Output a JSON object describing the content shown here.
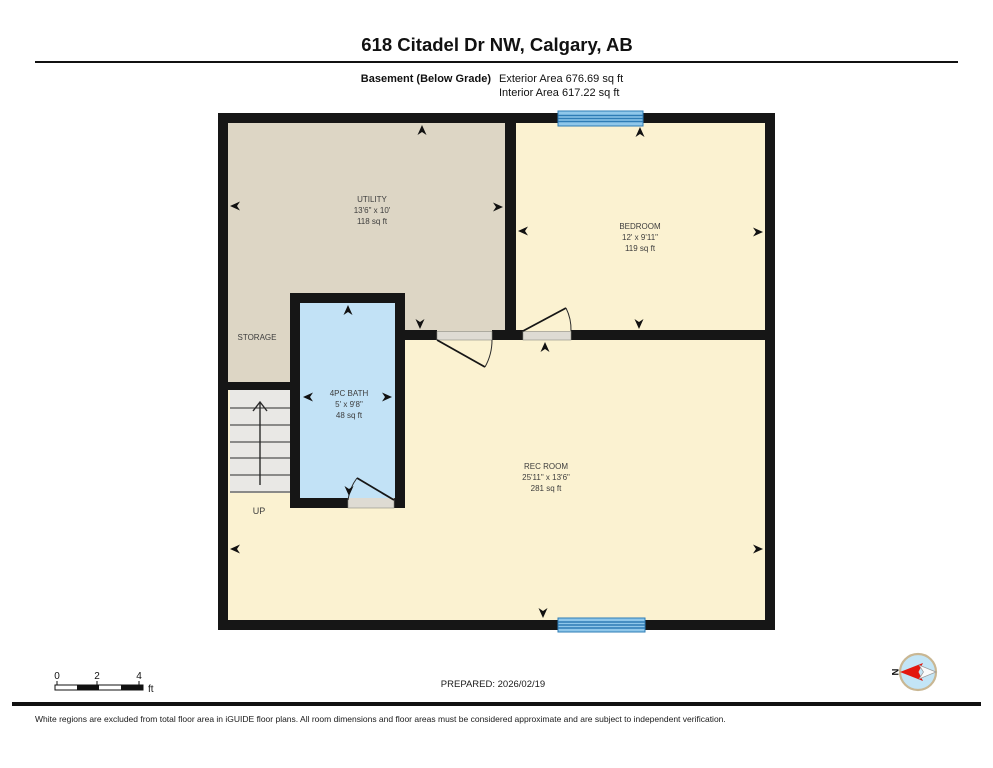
{
  "title": "618 Citadel Dr NW, Calgary, AB",
  "floor": {
    "label": "Basement (Below Grade)",
    "exterior": "Exterior Area 676.69 sq ft",
    "interior": "Interior Area 617.22 sq ft"
  },
  "rooms": [
    {
      "name": "UTILITY",
      "dims": "13'6\" x 10'",
      "area": "118 sq ft"
    },
    {
      "name": "BEDROOM",
      "dims": "12' x 9'11\"",
      "area": "119 sq ft"
    },
    {
      "name": "4PC BATH",
      "dims": "5' x 9'8\"",
      "area": "48 sq ft"
    },
    {
      "name": "REC ROOM",
      "dims": "25'11\" x 13'6\"",
      "area": "281 sq ft"
    }
  ],
  "annotations": {
    "storage": "STORAGE",
    "up": "UP",
    "north": "N"
  },
  "scale_bar": {
    "ticks": [
      "0",
      "2",
      "4"
    ],
    "unit": "ft"
  },
  "prepared": "PREPARED: 2026/02/19",
  "disclaimer": "White regions are excluded from total floor area in iGUIDE floor plans. All room dimensions and floor areas must be considered approximate and are subject to independent verification.",
  "colors": {
    "wall": "#161616",
    "utility_fill": "#DDD6C5",
    "bedroom_fill": "#FBF2D1",
    "bath_fill": "#C2E2F6",
    "stairs_fill": "#E9E8E5",
    "threshold_fill": "#DEDBD3",
    "window_blue": "#2E7CB5",
    "compass_red": "#E3180F"
  }
}
